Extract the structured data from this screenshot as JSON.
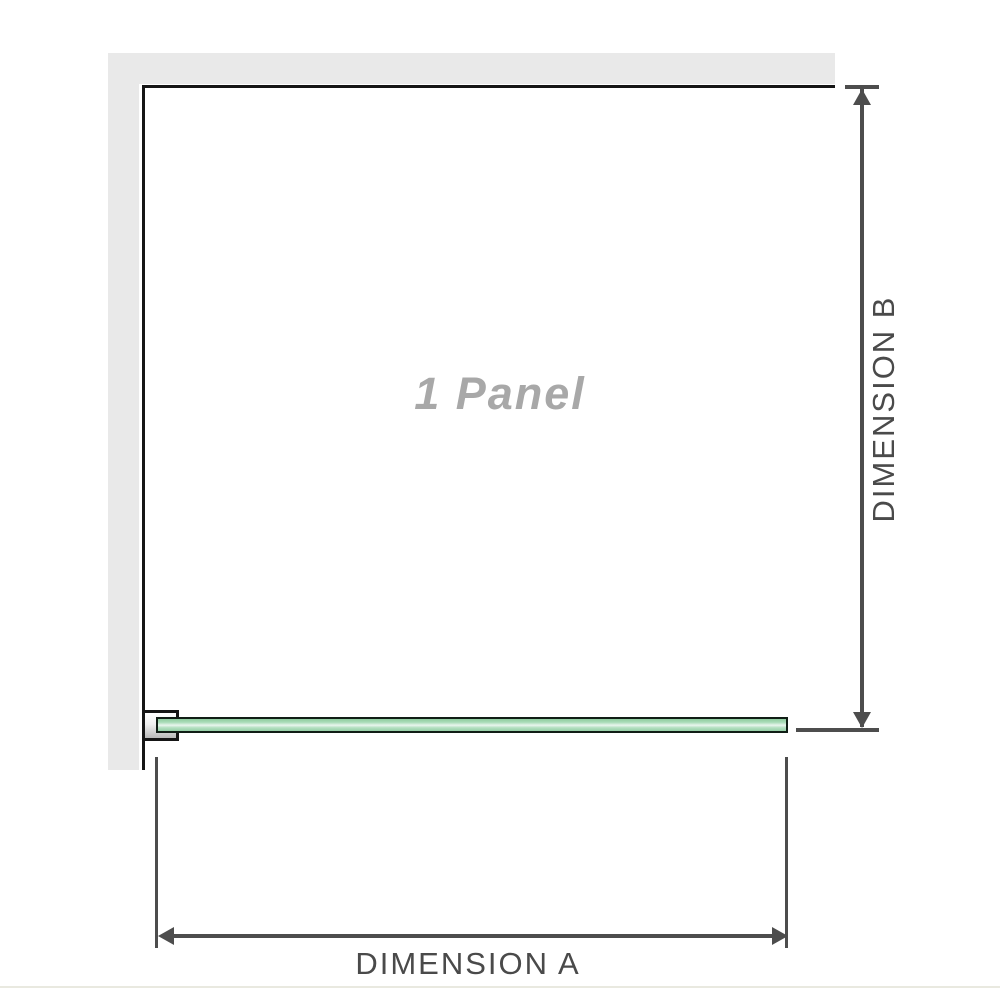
{
  "diagram": {
    "panel_label": "1 Panel",
    "dimensions": {
      "a_label": "DIMENSION A",
      "b_label": "DIMENSION B"
    },
    "colors": {
      "background": "#ffffff",
      "wall_fill": "#e9e9e9",
      "outline": "#151515",
      "dimension_lines": "#4d4d4d",
      "dimension_label_text": "#4a4a4a",
      "panel_label_text": "#a8a8a8",
      "glass_green": "#a3d9b3",
      "glass_highlight": "#e9f6ee",
      "glass_border": "#101d15",
      "bracket_fill_top": "#ffffff",
      "bracket_fill_bottom": "#b9b9b9",
      "bottom_edge_line": "#e9e9e0"
    }
  }
}
